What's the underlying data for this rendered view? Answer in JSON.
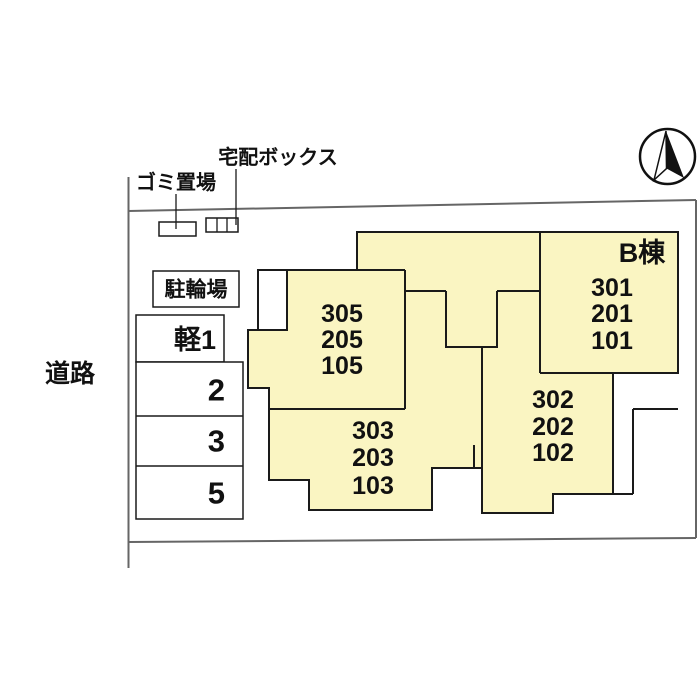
{
  "canvas": {
    "width": 700,
    "height": 700,
    "background": "#FFFFFF"
  },
  "colors": {
    "building_fill": "#FAF5C2",
    "building_outline": "#1A1A1A",
    "boundary_line": "#666666",
    "text": "#111111"
  },
  "site": {
    "road_label": "道路",
    "garbage_label": "ゴミ置場",
    "delivery_box_label": "宅配ボックス",
    "bicycle_parking_label": "駐輪場",
    "compass_icon": "north-arrow-icon"
  },
  "parking": {
    "kei_label": "軽1",
    "spot_labels": [
      "2",
      "3",
      "5"
    ]
  },
  "building": {
    "name_label": "B棟",
    "unit_stacks": [
      {
        "id": "west",
        "units": [
          "305",
          "205",
          "105"
        ]
      },
      {
        "id": "southwest",
        "units": [
          "303",
          "203",
          "103"
        ]
      },
      {
        "id": "south",
        "units": [
          "302",
          "202",
          "102"
        ]
      },
      {
        "id": "east",
        "units": [
          "301",
          "201",
          "101"
        ]
      }
    ]
  }
}
